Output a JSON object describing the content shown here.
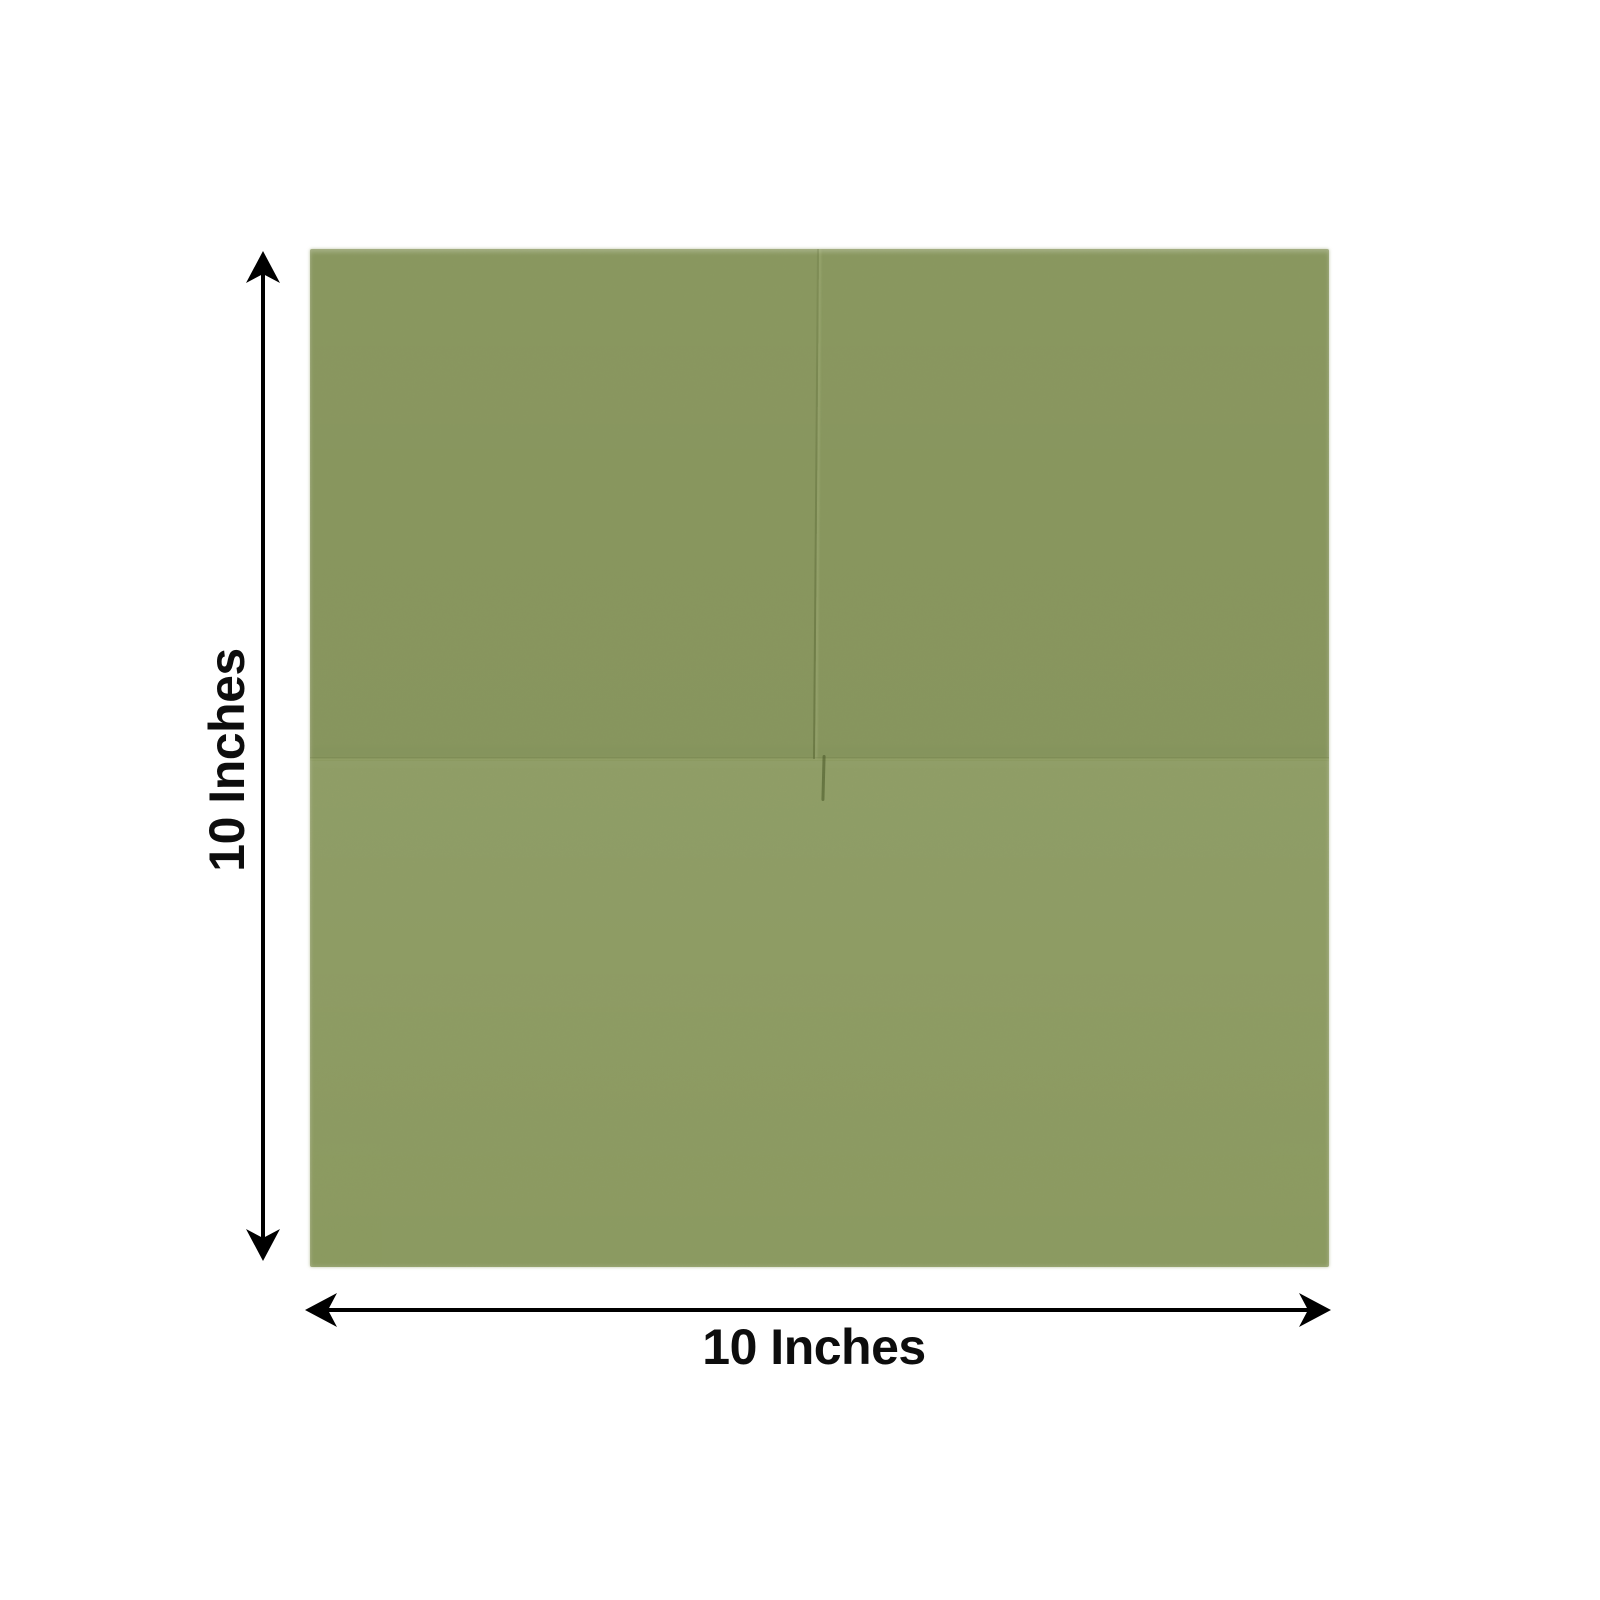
{
  "colors": {
    "background": "#ffffff",
    "napkin-green": "#8c9b61",
    "arrow-black": "#000000",
    "label-text": "#0d0d0d"
  },
  "dimensions": {
    "height": {
      "label": "10 Inches"
    },
    "width": {
      "label": "10 Inches"
    }
  }
}
